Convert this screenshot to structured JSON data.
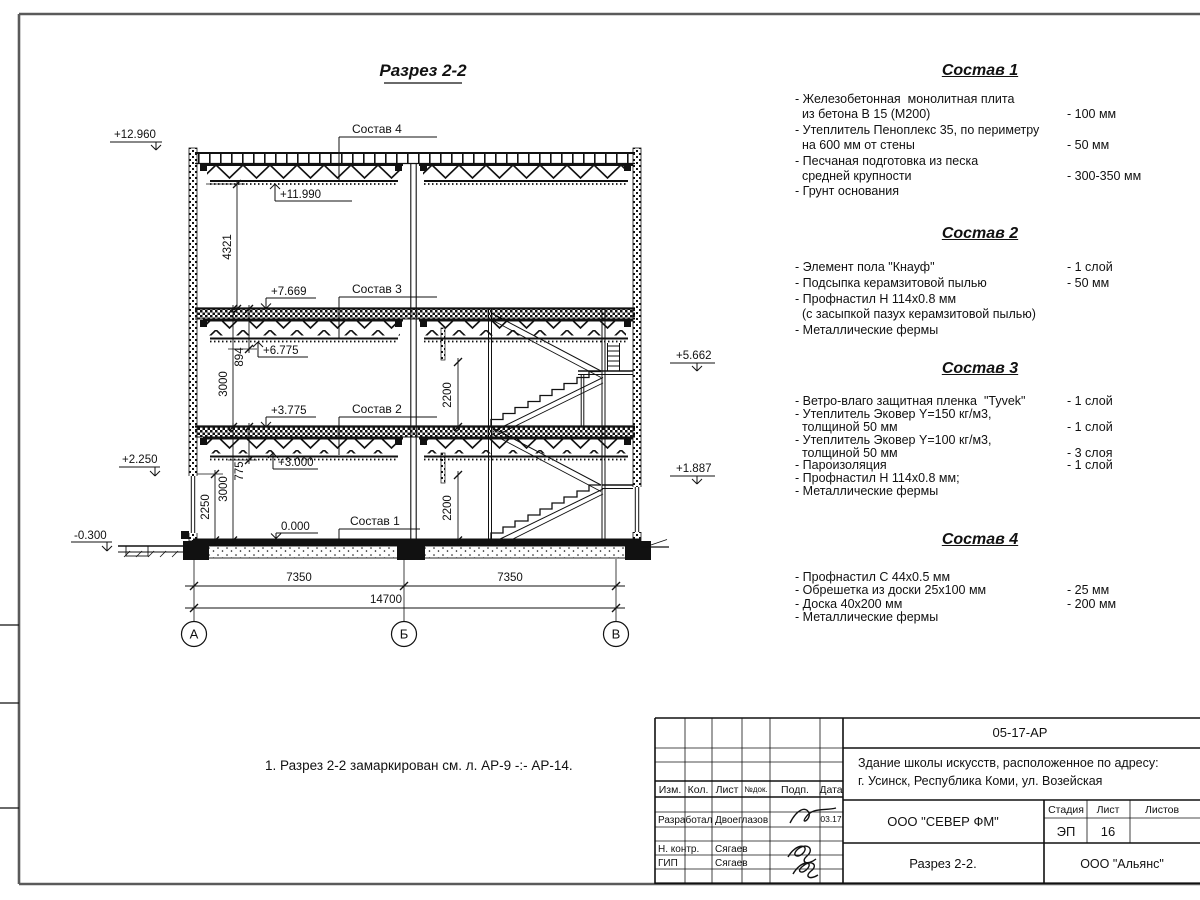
{
  "page": {
    "note": "1. Разрез 2-2 замаркирован см. л. АР-9 -:- АР-14."
  },
  "drawing": {
    "title": "Разрез 2-2",
    "axes": [
      {
        "label": "А"
      },
      {
        "label": "Б"
      },
      {
        "label": "В"
      }
    ],
    "elevations": {
      "roof_top": "+12.960",
      "roof_bottom": "+11.990",
      "floor3_top": "+7.669",
      "floor3_bottom": "+6.775",
      "floor2_top": "+3.775",
      "floor2_bottom": "+3.000",
      "sill": "+2.250",
      "ground": "0.000",
      "outside_ground": "-0.300",
      "landing2": "+5.662",
      "landing1": "+1.887"
    },
    "callouts": {
      "c4": "Состав 4",
      "c3": "Состав 3",
      "c2": "Состав 2",
      "c1": "Состав 1"
    },
    "dims": {
      "d4321": "4321",
      "d894": "894",
      "d3000a": "3000",
      "d775": "775",
      "d3000b": "3000",
      "d2250": "2250",
      "d2200a": "2200",
      "d2200b": "2200",
      "d7350a": "7350",
      "d7350b": "7350",
      "d14700": "14700"
    }
  },
  "compositions": [
    {
      "title": "Состав 1",
      "rows": [
        {
          "t": "- Железобетонная  монолитная плита",
          "v": ""
        },
        {
          "t": "  из бетона В 15 (М200)",
          "v": "- 100 мм"
        },
        {
          "t": "- Утеплитель Пеноплекс 35, по периметру",
          "v": ""
        },
        {
          "t": "  на 600 мм от стены",
          "v": "- 50 мм"
        },
        {
          "t": "- Песчаная подготовка из песка",
          "v": ""
        },
        {
          "t": "  средней крупности",
          "v": "- 300-350 мм"
        },
        {
          "t": "- Грунт основания",
          "v": ""
        }
      ]
    },
    {
      "title": "Состав 2",
      "rows": [
        {
          "t": "- Элемент пола \"Кнауф\"",
          "v": "- 1 слой"
        },
        {
          "t": "- Подсыпка керамзитовой пылью",
          "v": "- 50 мм"
        },
        {
          "t": "- Профнастил Н 114х0.8 мм",
          "v": ""
        },
        {
          "t": "  (с засыпкой пазух керамзитовой пылью)",
          "v": ""
        },
        {
          "t": "- Металлические фермы",
          "v": ""
        }
      ]
    },
    {
      "title": "Состав 3",
      "rows": [
        {
          "t": "- Ветро-влаго защитная пленка  \"Tyvek\"",
          "v": "- 1 слой"
        },
        {
          "t": "- Утеплитель Эковер Y=150 кг/м3,",
          "v": ""
        },
        {
          "t": "  толщиной 50 мм",
          "v": "- 1 слой"
        },
        {
          "t": "- Утеплитель Эковер Y=100 кг/м3,",
          "v": ""
        },
        {
          "t": "  толщиной 50 мм",
          "v": "- 3 слоя"
        },
        {
          "t": "- Пароизоляция",
          "v": "- 1 слой"
        },
        {
          "t": "- Профнастил Н 114х0.8 мм;",
          "v": ""
        },
        {
          "t": "- Металлические фермы",
          "v": ""
        }
      ]
    },
    {
      "title": "Состав 4",
      "rows": [
        {
          "t": "- Профнастил С 44х0.5 мм",
          "v": ""
        },
        {
          "t": "- Обрешетка из доски 25х100 мм",
          "v": "- 25 мм"
        },
        {
          "t": "- Доска 40х200 мм",
          "v": "- 200 мм"
        },
        {
          "t": "- Металлические фермы",
          "v": ""
        }
      ]
    }
  ],
  "title_block": {
    "code": "05-17-АР",
    "project_line1": "Здание школы искусств, расположенное по адресу:",
    "project_line2": "г. Усинск, Республика Коми, ул. Возейская",
    "cols": {
      "izm": "Изм.",
      "kol": "Кол.",
      "list": "Лист",
      "ndok": "№док.",
      "podp": "Подп.",
      "data": "Дата"
    },
    "roles": {
      "dev_label": "Разработал",
      "dev_name": "Двоеглазов",
      "dev_date": "03.17",
      "ncontr_label": "Н. контр.",
      "ncontr_name": "Сягаев",
      "gip_label": "ГИП",
      "gip_name": "Сягаев"
    },
    "company": "ООО \"СЕВЕР ФМ\"",
    "stage_label": "Стадия",
    "list_label": "Лист",
    "listov_label": "Листов",
    "stage": "ЭП",
    "sheet": "16",
    "title": "Разрез 2-2.",
    "org": "ООО \"Альянс\""
  },
  "colors": {
    "ink": "#111111",
    "frame": "#5a5a5a",
    "paper": "#ffffff"
  }
}
